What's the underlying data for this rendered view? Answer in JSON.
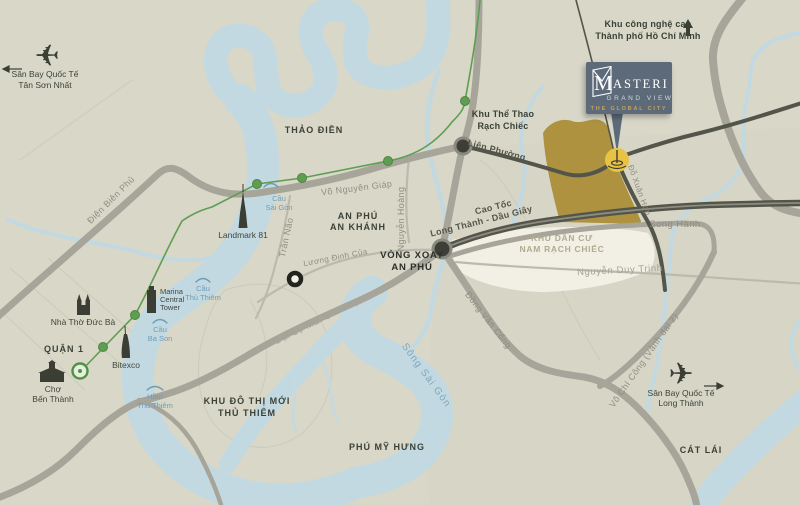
{
  "colors": {
    "background": "#d8d7c8",
    "river": "#c3d9e2",
    "site_gold": "#ae923f",
    "logo_bg": "#5c6b79",
    "logo_gold": "#c4a45e",
    "metro_green": "#5f9e50",
    "pin_yellow": "#e8c243",
    "road_dark": "#54554a"
  },
  "project": {
    "brand_initial": "M",
    "brand_rest": "ASTERI",
    "brand_sub": "GRAND VIEW",
    "brand_tagline": "THE GLOBAL CITY"
  },
  "areas": {
    "thao_dien": "THẢO ĐIỀN",
    "an_phu_1": "AN PHÚ",
    "an_phu_2": "AN KHÁNH",
    "vong_xoay_1": "VÒNG XOAY",
    "vong_xoay_2": "AN PHÚ",
    "thu_thiem_1": "KHU ĐÔ THỊ MỚI",
    "thu_thiem_2": "THỦ THIÊM",
    "phu_my_hung": "PHÚ MỸ HƯNG",
    "quan_1": "QUẬN 1",
    "cat_lai": "CÁT LÁI",
    "nam_rach_chiec_1": "KHU DÂN CƯ",
    "nam_rach_chiec_2": "NAM RẠCH CHIẾC",
    "the_thao_1": "Khu Thể Thao",
    "the_thao_2": "Rạch Chiếc",
    "cong_nghe_cao_1": "Khu công nghệ cao",
    "cong_nghe_cao_2": "Thành phố Hồ Chí Minh"
  },
  "roads": {
    "dien_bien_phu": "Điện Biên Phủ",
    "vo_nguyen_giap": "Võ Nguyên Giáp",
    "nguyen_hoang": "Nguyễn Hoàng",
    "tran_nao": "Trần Não",
    "luong_dinh_cua": "Lương Định Của",
    "lien_phuong": "Liên Phường",
    "cao_toc_1": "Cao Tốc",
    "cao_toc_2": "Long Thành - Dầu Giây",
    "song_hanh": "Song Hành",
    "do_xuan_hop": "Đỗ Xuân Hợp",
    "nguyen_duy_trinh": "Nguyễn Duy Trinh",
    "dong_van_cong": "Đồng Văn Cống",
    "mai_chi_tho": "Đại Lộ Mai Chí Thọ",
    "vo_chi_cong": "Võ Chí Công (Vành đai 2)"
  },
  "water": {
    "song_sai_gon": "Sông Sài Gòn"
  },
  "bridges": {
    "csg_1": "Cầu",
    "csg_2": "Sài Gòn",
    "ctt_1": "Cầu",
    "ctt_2": "Thủ Thiêm",
    "cbs_1": "Cầu",
    "cbs_2": "Ba Son",
    "htt_1": "Hầm",
    "htt_2": "Thủ Thiêm"
  },
  "landmarks": {
    "landmark81": "Landmark 81",
    "marina_1": "Marina",
    "marina_2": "Central",
    "marina_3": "Tower",
    "nha_tho_duc_ba": "Nhà Thờ Đức Bà",
    "cho_1": "Chợ",
    "cho_2": "Bến Thành",
    "bitexco": "Bitexco"
  },
  "airports": {
    "tsn_1": "Sân Bay Quốc Tế",
    "tsn_2": "Tân Sơn Nhất",
    "lt_1": "Sân Bay Quốc Tế",
    "lt_2": "Long Thành"
  }
}
